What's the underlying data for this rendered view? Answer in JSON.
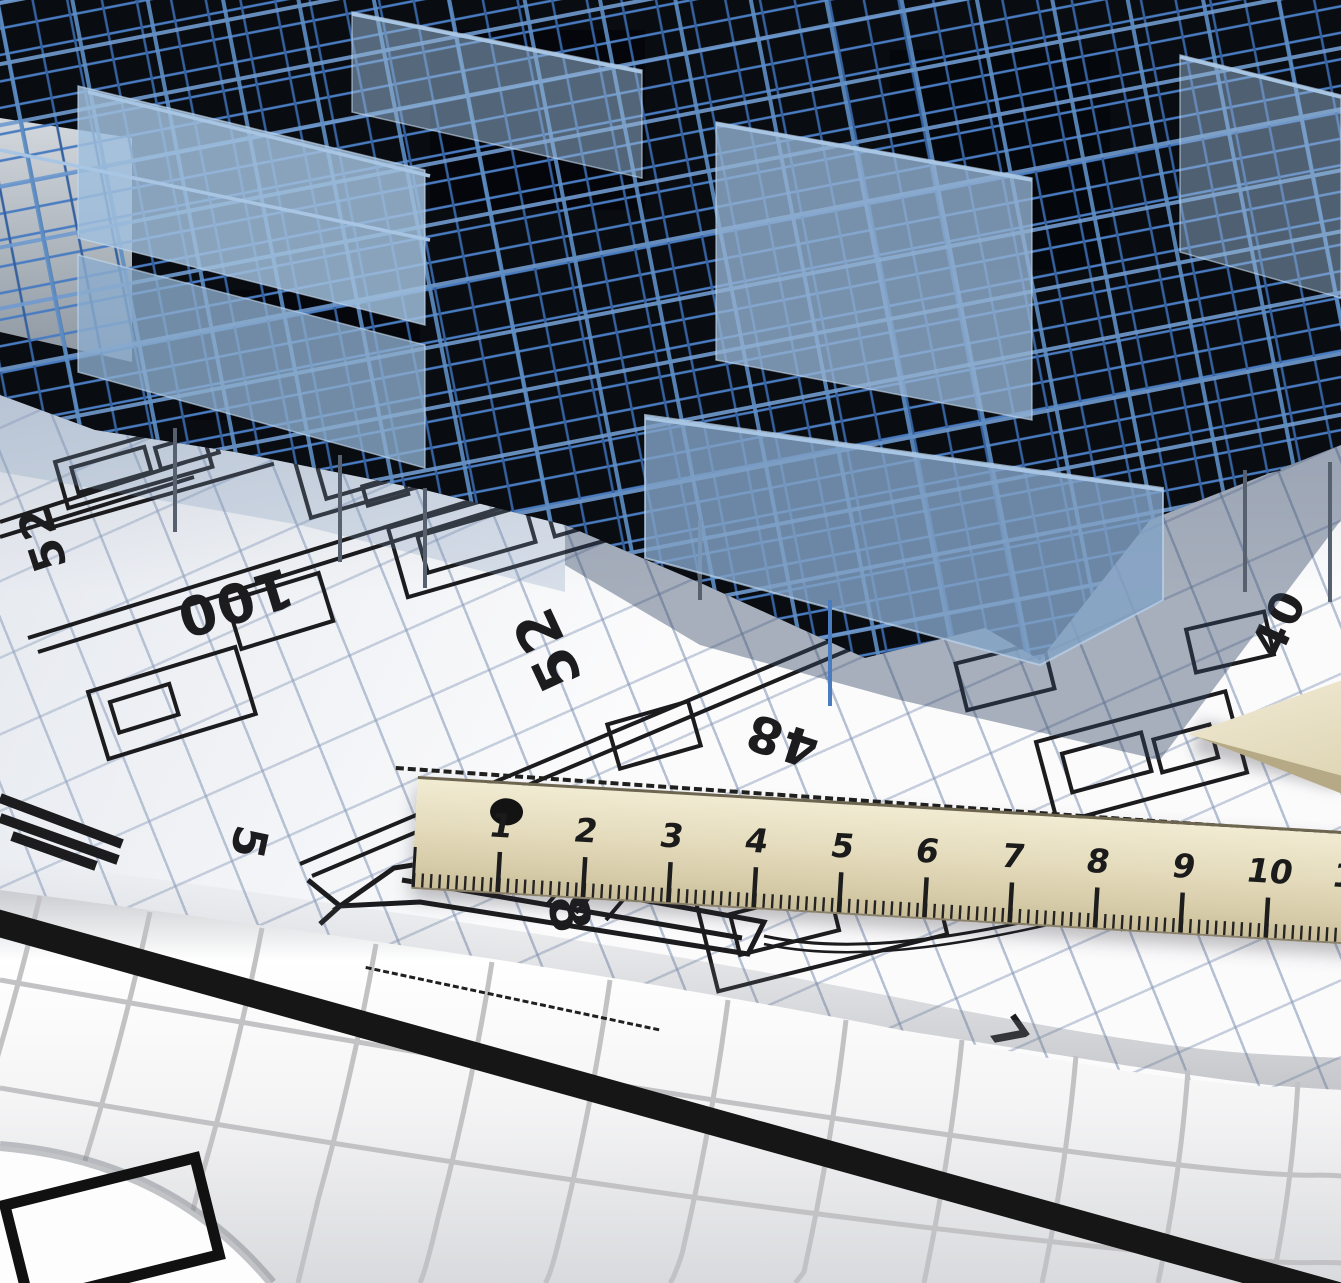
{
  "scene": {
    "description": "Photo-style architectural scene: translucent blue 3D wireframe building model standing on a white blueprint floor plan, with a wooden ruler, a wooden set-square tip and rolled blueprint sheets in the foreground",
    "objects": [
      "building-wireframe-model",
      "blueprint-floor-plan",
      "wooden-ruler",
      "set-square",
      "rolled-blueprints"
    ],
    "colors": {
      "paper_white": "#fbfbfc",
      "grid_blue_gray": "#7c90b2",
      "plan_line_black": "#1c1c1e",
      "building_frame_blue": "#4a7cc2",
      "building_frame_deep_blue": "#35619f",
      "building_panel_blue": "#93b2d2",
      "building_void_dark": "#090c11",
      "cast_shadow_blue": "#32465f",
      "ruler_wood": "#e4dbbc",
      "ruler_marks": "#1d1d1d",
      "roll_grid_gray": "#c2c2c4",
      "thick_line_black": "#161616"
    }
  },
  "blueprint": {
    "dimension_labels": [
      "52",
      "100",
      "52",
      "48",
      "40",
      "40",
      "5",
      "48",
      "7",
      "52",
      "25"
    ]
  },
  "ruler": {
    "numbers": [
      "1",
      "2",
      "3",
      "4",
      "5",
      "6",
      "7",
      "8",
      "9",
      "10",
      "11"
    ],
    "hole_icon": "ruler-hole-dot"
  }
}
